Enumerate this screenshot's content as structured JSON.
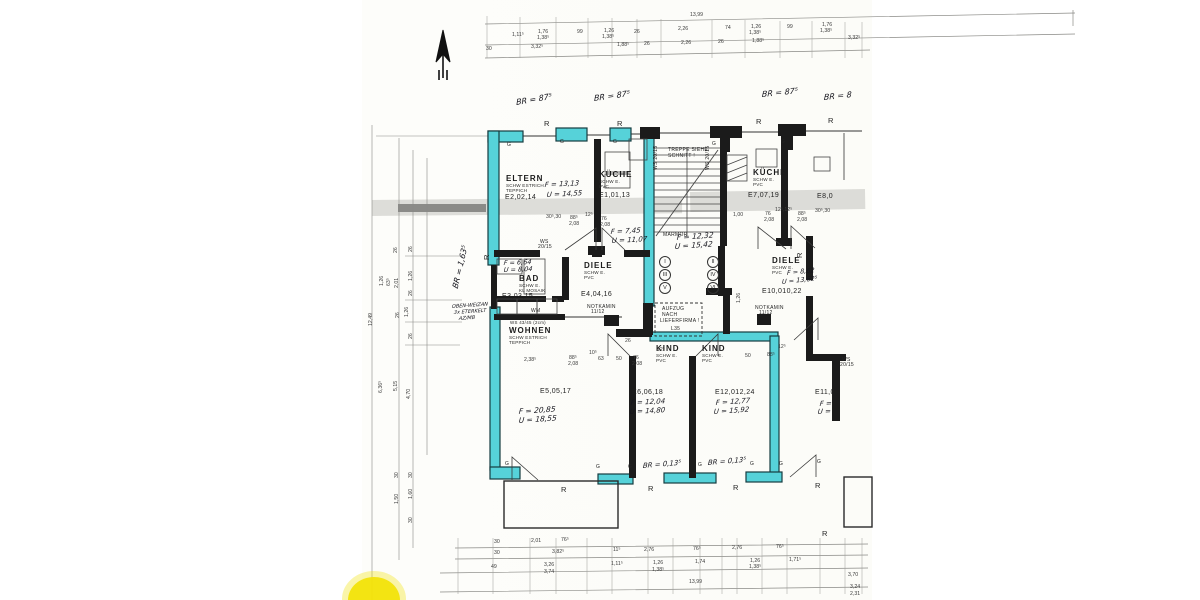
{
  "colors": {
    "wall_highlight": "#56d2d9",
    "ink": "#1c1c1c",
    "paper": "#ffffff",
    "yellow_marker": "#f2e30a"
  },
  "plan": {
    "room_names": [
      {
        "t": "ELTERN",
        "x": 506,
        "y": 175
      },
      {
        "t": "KÜCHE",
        "x": 599,
        "y": 171
      },
      {
        "t": "BAD",
        "x": 519,
        "y": 275
      },
      {
        "t": "DIELE",
        "x": 584,
        "y": 262
      },
      {
        "t": "WOHNEN",
        "x": 509,
        "y": 327
      },
      {
        "t": "KIND",
        "x": 656,
        "y": 345
      },
      {
        "t": "KIND",
        "x": 702,
        "y": 345
      },
      {
        "t": "KÜCHE",
        "x": 753,
        "y": 169
      },
      {
        "t": "DIELE",
        "x": 772,
        "y": 257
      }
    ],
    "room_subs": [
      {
        "t": "SCHW ESTRICH",
        "x": 506,
        "y": 184
      },
      {
        "t": "TEPPICH",
        "x": 506,
        "y": 189
      },
      {
        "t": "SCHW E.",
        "x": 599,
        "y": 180
      },
      {
        "t": "PVC",
        "x": 599,
        "y": 185
      },
      {
        "t": "SCHW E.",
        "x": 519,
        "y": 284
      },
      {
        "t": "KL MOSAIK",
        "x": 519,
        "y": 289
      },
      {
        "t": "SCHW E.",
        "x": 584,
        "y": 271
      },
      {
        "t": "PVC",
        "x": 584,
        "y": 276
      },
      {
        "t": "SCHW ESTRICH",
        "x": 509,
        "y": 336
      },
      {
        "t": "TEPPICH",
        "x": 509,
        "y": 341
      },
      {
        "t": "SCHW E.",
        "x": 656,
        "y": 354
      },
      {
        "t": "PVC",
        "x": 656,
        "y": 359
      },
      {
        "t": "SCHW E.",
        "x": 702,
        "y": 354
      },
      {
        "t": "PVC",
        "x": 702,
        "y": 359
      },
      {
        "t": "SCHW E.",
        "x": 753,
        "y": 178
      },
      {
        "t": "PVC",
        "x": 753,
        "y": 183
      },
      {
        "t": "SCHW E.",
        "x": 772,
        "y": 266
      },
      {
        "t": "PVC",
        "x": 772,
        "y": 271
      }
    ],
    "room_codes": [
      {
        "t": "E2,02,14",
        "x": 505,
        "y": 194
      },
      {
        "t": "E1,01,13",
        "x": 599,
        "y": 192
      },
      {
        "t": "E3,03,15",
        "x": 502,
        "y": 293
      },
      {
        "t": "E4,04,16",
        "x": 581,
        "y": 291
      },
      {
        "t": "E5,05,17",
        "x": 540,
        "y": 388
      },
      {
        "t": "E6,06,18",
        "x": 632,
        "y": 389
      },
      {
        "t": "E12,012,24",
        "x": 715,
        "y": 389
      },
      {
        "t": "E7,07,19",
        "x": 748,
        "y": 192
      },
      {
        "t": "E10,010,22",
        "x": 762,
        "y": 288
      },
      {
        "t": "E8,0",
        "x": 817,
        "y": 193
      },
      {
        "t": "E11,0",
        "x": 815,
        "y": 389
      }
    ],
    "notes": [
      {
        "t": "TREPPE SIEHE",
        "x": 668,
        "y": 148
      },
      {
        "t": "SCHNITT !",
        "x": 668,
        "y": 154
      },
      {
        "t": "MARMOR",
        "x": 663,
        "y": 233
      },
      {
        "t": "AUFZUG",
        "x": 662,
        "y": 307
      },
      {
        "t": "NACH",
        "x": 662,
        "y": 313
      },
      {
        "t": "LIEFERFIRMA !",
        "x": 660,
        "y": 319
      },
      {
        "t": "L35",
        "x": 671,
        "y": 327
      },
      {
        "t": "NOTKAMIN",
        "x": 587,
        "y": 305
      },
      {
        "t": "11/12",
        "x": 591,
        "y": 310
      },
      {
        "t": "NOTKAMIN",
        "x": 755,
        "y": 306
      },
      {
        "t": "11/12",
        "x": 759,
        "y": 311
      },
      {
        "t": "WM",
        "x": 531,
        "y": 309
      },
      {
        "t": "WS",
        "x": 540,
        "y": 240
      },
      {
        "t": "20/15",
        "x": 538,
        "y": 245
      },
      {
        "t": "WS",
        "x": 842,
        "y": 358
      },
      {
        "t": "20/15",
        "x": 840,
        "y": 363
      },
      {
        "t": "WS 20/15",
        "x": 654,
        "y": 170,
        "r": -90
      },
      {
        "t": "WS 20/15",
        "x": 706,
        "y": 170,
        "r": -90
      },
      {
        "t": "WS 43/45 (2cm)",
        "x": 510,
        "y": 321,
        "s": 4.4
      }
    ],
    "letters": [
      {
        "t": "R",
        "x": 544,
        "y": 120
      },
      {
        "t": "R",
        "x": 617,
        "y": 120
      },
      {
        "t": "R",
        "x": 756,
        "y": 118
      },
      {
        "t": "R",
        "x": 828,
        "y": 117
      },
      {
        "t": "R",
        "x": 561,
        "y": 486
      },
      {
        "t": "R",
        "x": 648,
        "y": 485
      },
      {
        "t": "R",
        "x": 733,
        "y": 484
      },
      {
        "t": "R",
        "x": 815,
        "y": 482
      },
      {
        "t": "R",
        "x": 822,
        "y": 530
      },
      {
        "t": "R",
        "x": 483,
        "y": 260,
        "r": -90
      },
      {
        "t": "R",
        "x": 796,
        "y": 258,
        "r": -90
      },
      {
        "t": "G",
        "x": 507,
        "y": 143,
        "s": 5
      },
      {
        "t": "G",
        "x": 560,
        "y": 140,
        "s": 5
      },
      {
        "t": "G",
        "x": 613,
        "y": 140,
        "s": 5
      },
      {
        "t": "G",
        "x": 712,
        "y": 142,
        "s": 5
      },
      {
        "t": "G",
        "x": 781,
        "y": 140,
        "s": 5
      },
      {
        "t": "G",
        "x": 505,
        "y": 462,
        "s": 5
      },
      {
        "t": "G",
        "x": 596,
        "y": 465,
        "s": 5
      },
      {
        "t": "G",
        "x": 628,
        "y": 465,
        "s": 5
      },
      {
        "t": "G",
        "x": 698,
        "y": 463,
        "s": 5
      },
      {
        "t": "G",
        "x": 750,
        "y": 462,
        "s": 5
      },
      {
        "t": "G",
        "x": 779,
        "y": 462,
        "s": 5
      },
      {
        "t": "G",
        "x": 817,
        "y": 460,
        "s": 5
      }
    ],
    "handwritten": [
      {
        "t": "BR = 87⁵",
        "x": 516,
        "y": 99,
        "r": -10
      },
      {
        "t": "BR = 87⁵",
        "x": 594,
        "y": 95,
        "r": -8
      },
      {
        "t": "BR = 87⁵",
        "x": 762,
        "y": 91,
        "r": -6
      },
      {
        "t": "BR = 8",
        "x": 824,
        "y": 94,
        "r": -6
      },
      {
        "t": "BR = 1,63⁵",
        "x": 452,
        "y": 287,
        "r": -77
      },
      {
        "t": "BR = 0,13⁵",
        "x": 643,
        "y": 463,
        "r": -5,
        "s": 7
      },
      {
        "t": "BR = 0,13⁵",
        "x": 708,
        "y": 460,
        "r": -5,
        "s": 7
      },
      {
        "t": "F = 13,13",
        "x": 545,
        "y": 182,
        "r": -3,
        "s": 7
      },
      {
        "t": "U = 14,55",
        "x": 547,
        "y": 192,
        "r": -3,
        "s": 7
      },
      {
        "t": "F = 7,45",
        "x": 611,
        "y": 229,
        "r": -3,
        "s": 7
      },
      {
        "t": "U = 11,07",
        "x": 612,
        "y": 238,
        "r": -3,
        "s": 7
      },
      {
        "t": "F = 6,64",
        "x": 504,
        "y": 260,
        "r": -2,
        "s": 6.5
      },
      {
        "t": "U = 8,04",
        "x": 504,
        "y": 267,
        "r": -2,
        "s": 6.5
      },
      {
        "t": "F = 12,32",
        "x": 677,
        "y": 234,
        "r": -4,
        "s": 7.5
      },
      {
        "t": "U = 15,42",
        "x": 675,
        "y": 243,
        "r": -4,
        "s": 7.5
      },
      {
        "t": "F = 20,85",
        "x": 519,
        "y": 408,
        "r": -4,
        "s": 7.5
      },
      {
        "t": "U = 18,55",
        "x": 519,
        "y": 417,
        "r": -4,
        "s": 7.5
      },
      {
        "t": "F = 12,04",
        "x": 631,
        "y": 400,
        "r": -3,
        "s": 7
      },
      {
        "t": "U = 14,80",
        "x": 630,
        "y": 409,
        "r": -3,
        "s": 7
      },
      {
        "t": "F = 12,77",
        "x": 716,
        "y": 400,
        "r": -4,
        "s": 7
      },
      {
        "t": "U = 15,92",
        "x": 714,
        "y": 409,
        "r": -4,
        "s": 7
      },
      {
        "t": "F = 8,62",
        "x": 787,
        "y": 270,
        "r": -6,
        "s": 6.5
      },
      {
        "t": "U = 13,62⁵",
        "x": 782,
        "y": 279,
        "r": -6,
        "s": 6.5
      },
      {
        "t": "F =",
        "x": 820,
        "y": 401,
        "r": -3,
        "s": 7
      },
      {
        "t": "U =",
        "x": 818,
        "y": 409,
        "r": -3,
        "s": 7
      },
      {
        "t": "OBEN-WEIZAN",
        "x": 452,
        "y": 305,
        "r": -4,
        "s": 5
      },
      {
        "t": "3x ETERKELT",
        "x": 454,
        "y": 311,
        "r": -4,
        "s": 5
      },
      {
        "t": "AZ/MB",
        "x": 459,
        "y": 317,
        "r": -4,
        "s": 5
      }
    ],
    "dims": [
      {
        "t": "13,99",
        "x": 690,
        "y": 13
      },
      {
        "t": "1,11⁵",
        "x": 512,
        "y": 33
      },
      {
        "t": "1,76",
        "x": 538,
        "y": 30
      },
      {
        "t": "1,38⁵",
        "x": 537,
        "y": 36
      },
      {
        "t": "99",
        "x": 577,
        "y": 30
      },
      {
        "t": "1,26",
        "x": 604,
        "y": 29
      },
      {
        "t": "1,38⁵",
        "x": 602,
        "y": 35
      },
      {
        "t": "26",
        "x": 634,
        "y": 30
      },
      {
        "t": "2,26",
        "x": 678,
        "y": 27
      },
      {
        "t": "74",
        "x": 725,
        "y": 26
      },
      {
        "t": "1,26",
        "x": 751,
        "y": 25
      },
      {
        "t": "1,38⁵",
        "x": 749,
        "y": 31
      },
      {
        "t": "99",
        "x": 787,
        "y": 25
      },
      {
        "t": "1,76",
        "x": 822,
        "y": 23
      },
      {
        "t": "1,38⁵",
        "x": 820,
        "y": 29
      },
      {
        "t": "30",
        "x": 486,
        "y": 47
      },
      {
        "t": "3,32⁵",
        "x": 531,
        "y": 45
      },
      {
        "t": "1,88⁵",
        "x": 617,
        "y": 43
      },
      {
        "t": "26",
        "x": 644,
        "y": 42
      },
      {
        "t": "2,26",
        "x": 681,
        "y": 41
      },
      {
        "t": "26",
        "x": 718,
        "y": 40
      },
      {
        "t": "1,88⁵",
        "x": 752,
        "y": 39
      },
      {
        "t": "3,32⁵",
        "x": 848,
        "y": 36
      },
      {
        "t": "30⁵,30",
        "x": 546,
        "y": 215
      },
      {
        "t": "88⁵",
        "x": 570,
        "y": 216
      },
      {
        "t": "2,08",
        "x": 569,
        "y": 222
      },
      {
        "t": "12⁵",
        "x": 585,
        "y": 213
      },
      {
        "t": "76",
        "x": 601,
        "y": 217
      },
      {
        "t": "2,08",
        "x": 600,
        "y": 223
      },
      {
        "t": "1,00",
        "x": 733,
        "y": 213
      },
      {
        "t": "76",
        "x": 765,
        "y": 212
      },
      {
        "t": "2,08",
        "x": 764,
        "y": 218
      },
      {
        "t": "12⁵,12⁵",
        "x": 775,
        "y": 208
      },
      {
        "t": "88⁵",
        "x": 798,
        "y": 212
      },
      {
        "t": "2,08",
        "x": 797,
        "y": 218
      },
      {
        "t": "30⁵,30",
        "x": 815,
        "y": 209
      },
      {
        "t": "2,38⁵",
        "x": 524,
        "y": 358
      },
      {
        "t": "10⁵",
        "x": 589,
        "y": 351
      },
      {
        "t": "88⁵",
        "x": 569,
        "y": 356
      },
      {
        "t": "2,08",
        "x": 568,
        "y": 362
      },
      {
        "t": "63",
        "x": 598,
        "y": 357
      },
      {
        "t": "50",
        "x": 616,
        "y": 357
      },
      {
        "t": "76",
        "x": 633,
        "y": 356
      },
      {
        "t": "2,08",
        "x": 632,
        "y": 362
      },
      {
        "t": "12⁵",
        "x": 657,
        "y": 348
      },
      {
        "t": "26",
        "x": 625,
        "y": 339
      },
      {
        "t": "50",
        "x": 745,
        "y": 354
      },
      {
        "t": "88⁵",
        "x": 767,
        "y": 353
      },
      {
        "t": "12⁵",
        "x": 778,
        "y": 345
      },
      {
        "t": "1,26",
        "x": 737,
        "y": 303,
        "r": -90
      },
      {
        "t": "26",
        "x": 394,
        "y": 253,
        "r": -90
      },
      {
        "t": "26",
        "x": 409,
        "y": 252,
        "r": -90
      },
      {
        "t": "1,26",
        "x": 380,
        "y": 286,
        "r": -90
      },
      {
        "t": "63⁵",
        "x": 387,
        "y": 286,
        "r": -90
      },
      {
        "t": "2,01",
        "x": 395,
        "y": 288,
        "r": -90
      },
      {
        "t": "1,26",
        "x": 409,
        "y": 281,
        "r": -90
      },
      {
        "t": "26",
        "x": 409,
        "y": 296,
        "r": -90
      },
      {
        "t": "26",
        "x": 396,
        "y": 318,
        "r": -90
      },
      {
        "t": "1,26",
        "x": 405,
        "y": 317,
        "r": -90
      },
      {
        "t": "26",
        "x": 409,
        "y": 339,
        "r": -90
      },
      {
        "t": "12,49",
        "x": 369,
        "y": 326,
        "r": -90
      },
      {
        "t": "6,36⁵",
        "x": 379,
        "y": 393,
        "r": -90
      },
      {
        "t": "5,15",
        "x": 394,
        "y": 391,
        "r": -90
      },
      {
        "t": "4,70",
        "x": 407,
        "y": 399,
        "r": -90
      },
      {
        "t": "30",
        "x": 395,
        "y": 478,
        "r": -90
      },
      {
        "t": "30",
        "x": 409,
        "y": 478,
        "r": -90
      },
      {
        "t": "1,50",
        "x": 395,
        "y": 504,
        "r": -90
      },
      {
        "t": "1,60",
        "x": 409,
        "y": 499,
        "r": -90
      },
      {
        "t": "30",
        "x": 409,
        "y": 523,
        "r": -90
      },
      {
        "t": "30",
        "x": 494,
        "y": 540
      },
      {
        "t": "2,01",
        "x": 531,
        "y": 539
      },
      {
        "t": "76⁵",
        "x": 561,
        "y": 538
      },
      {
        "t": "30",
        "x": 494,
        "y": 551
      },
      {
        "t": "3,82⁵",
        "x": 552,
        "y": 550
      },
      {
        "t": "11⁵",
        "x": 613,
        "y": 548
      },
      {
        "t": "2,76",
        "x": 644,
        "y": 548
      },
      {
        "t": "76⁵",
        "x": 693,
        "y": 547
      },
      {
        "t": "2,76",
        "x": 732,
        "y": 546
      },
      {
        "t": "76⁵",
        "x": 776,
        "y": 545
      },
      {
        "t": "49",
        "x": 491,
        "y": 565
      },
      {
        "t": "3,26",
        "x": 544,
        "y": 563
      },
      {
        "t": "3,74",
        "x": 544,
        "y": 570
      },
      {
        "t": "1,11⁵",
        "x": 611,
        "y": 562
      },
      {
        "t": "1,26",
        "x": 653,
        "y": 561
      },
      {
        "t": "1,38⁵",
        "x": 652,
        "y": 568
      },
      {
        "t": "1,74",
        "x": 695,
        "y": 560
      },
      {
        "t": "1,26",
        "x": 750,
        "y": 559
      },
      {
        "t": "1,38⁵",
        "x": 749,
        "y": 565
      },
      {
        "t": "1,71⁵",
        "x": 789,
        "y": 558
      },
      {
        "t": "13,99",
        "x": 689,
        "y": 580
      },
      {
        "t": "3,70",
        "x": 848,
        "y": 573
      },
      {
        "t": "3,24",
        "x": 850,
        "y": 585
      },
      {
        "t": "2,31",
        "x": 850,
        "y": 592
      }
    ],
    "units": [
      {
        "t": "I",
        "x": 659,
        "y": 256
      },
      {
        "t": "III",
        "x": 659,
        "y": 269
      },
      {
        "t": "V",
        "x": 659,
        "y": 282
      },
      {
        "t": "II",
        "x": 707,
        "y": 256
      },
      {
        "t": "IV",
        "x": 707,
        "y": 269
      },
      {
        "t": "VI",
        "x": 707,
        "y": 282
      }
    ]
  }
}
